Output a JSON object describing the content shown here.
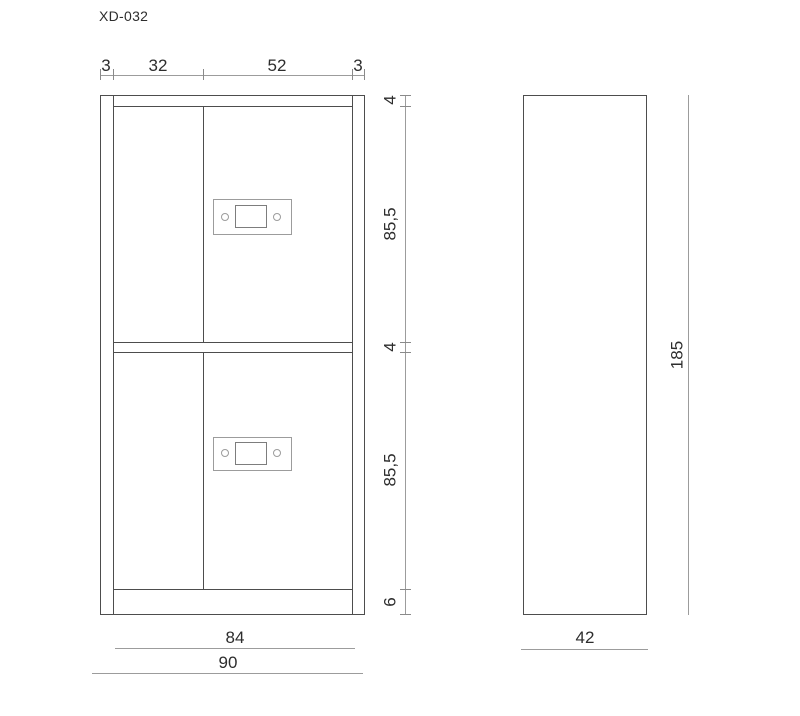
{
  "drawing": {
    "title": "XD-032",
    "front_view": {
      "description": "cabinet front elevation with two locker doors",
      "top_dimension_chain": {
        "segments": [
          "3",
          "32",
          "52",
          "3"
        ]
      },
      "right_dimension_chain": {
        "segments": [
          "4",
          "85,5",
          "4",
          "85,5",
          "6"
        ]
      },
      "bottom_dimensions": {
        "inner_width": "84",
        "overall_width": "90"
      }
    },
    "side_view": {
      "description": "cabinet side elevation",
      "depth_dimension": "42",
      "height_dimension": "185"
    },
    "colors": {
      "outline": "#4d4d4d",
      "dimension_line": "#9c9c9c",
      "hardware_line": "#9c9c9c",
      "text": "#2d2d2d",
      "background": "#ffffff"
    }
  }
}
